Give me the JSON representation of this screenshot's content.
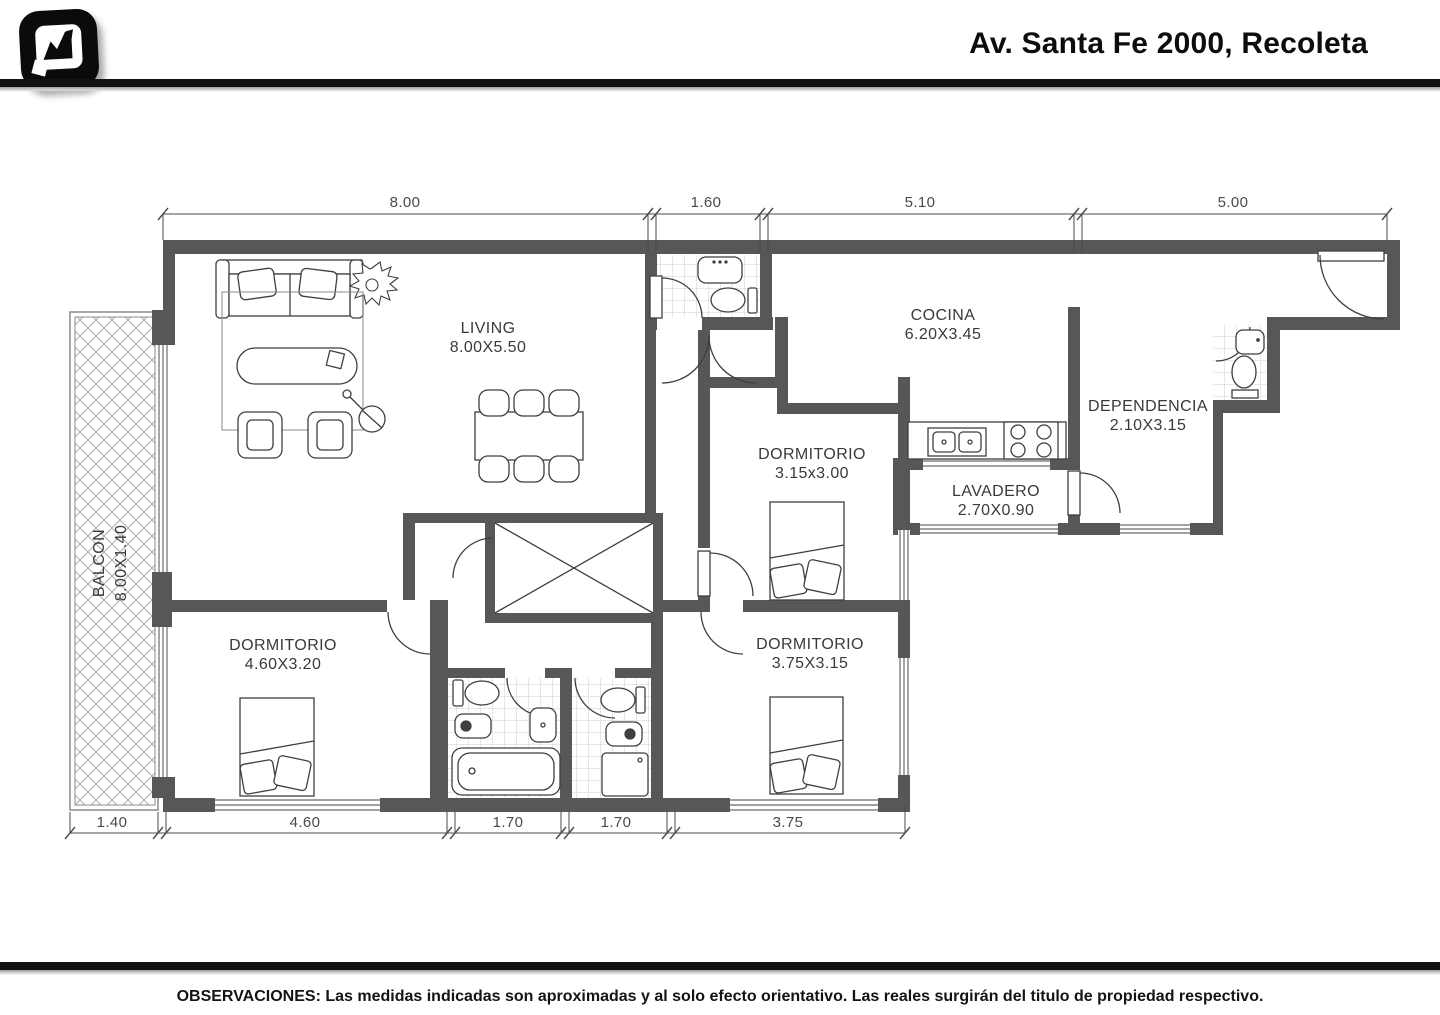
{
  "header": {
    "title": "Av. Santa Fe 2000, Recoleta",
    "logo_icon": "chart-zigzag-logo"
  },
  "plan": {
    "rooms": [
      {
        "name": "LIVING",
        "size": "8.00X5.50"
      },
      {
        "name": "COCINA",
        "size": "6.20X3.45"
      },
      {
        "name": "DEPENDENCIA",
        "size": "2.10X3.15"
      },
      {
        "name": "LAVADERO",
        "size": "2.70X0.90"
      },
      {
        "name": "DORMITORIO",
        "size": "3.15x3.00"
      },
      {
        "name": "DORMITORIO",
        "size": "4.60X3.20"
      },
      {
        "name": "DORMITORIO",
        "size": "3.75X3.15"
      },
      {
        "name": "BALCON",
        "size": "8.00X1.40"
      }
    ],
    "dimensions_top": [
      "8.00",
      "1.60",
      "5.10",
      "5.00"
    ],
    "dimensions_bottom": [
      "1.40",
      "4.60",
      "1.70",
      "1.70",
      "3.75"
    ]
  },
  "footer": {
    "observaciones": "OBSERVACIONES: Las medidas indicadas son aproximadas y al solo efecto orientativo. Las reales surgirán del titulo de propiedad respectivo."
  },
  "colors": {
    "wall": "#57575a",
    "line": "#3f3f3f",
    "tile": "#cfcfcf",
    "hatch": "#adadad",
    "bar": "#121212"
  }
}
